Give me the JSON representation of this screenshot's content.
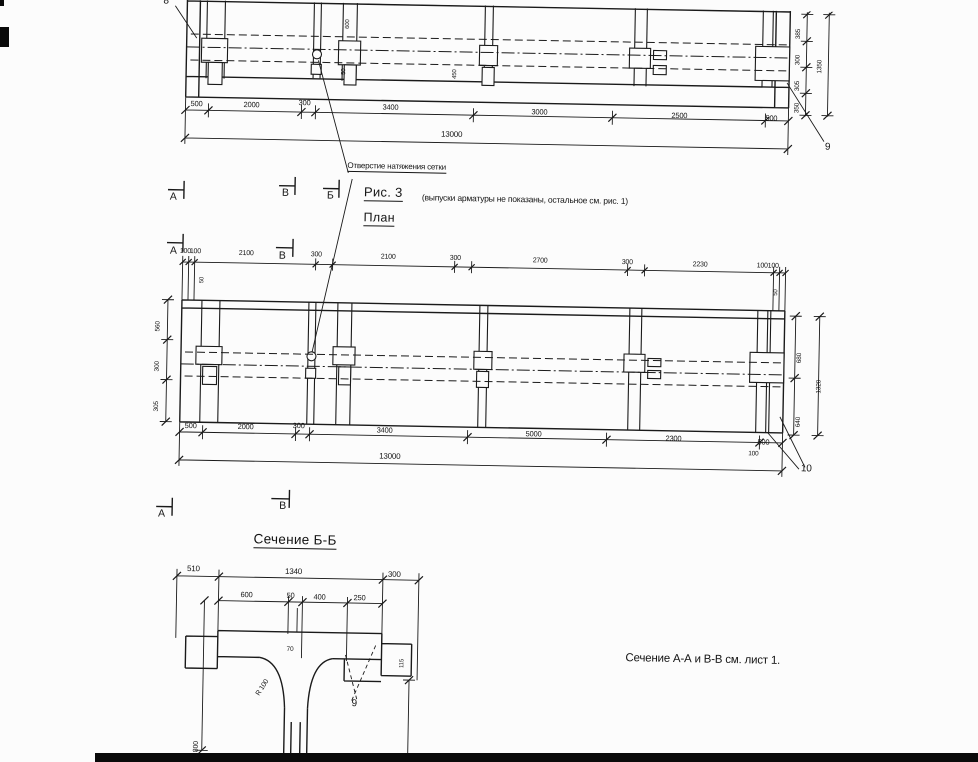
{
  "colors": {
    "ink": "#1a1a1a",
    "paper": "#fcfcfc",
    "scan_band": "#0a0a0a"
  },
  "titles": {
    "figure_caption": "Рис. 3",
    "figure_note": "(выпуски арматуры не показаны, остальное  см. рис. 1)",
    "plan_title": "План",
    "section_title": "Сечение Б-Б",
    "sheet_note": "Сечение  А-А и В-В   см. лист 1.",
    "hole_callout": "Отверстие натяжения сетки"
  },
  "labels": [
    {
      "n": "hole-callout",
      "t": "Отверстие натяжения сетки",
      "x": 349,
      "y": 159,
      "fs": 8,
      "u": 1
    },
    {
      "n": "figure-caption",
      "t": "Рис. 3",
      "x": 366,
      "y": 182,
      "fs": 13,
      "u": 1,
      "cls": "big"
    },
    {
      "n": "figure-note",
      "t": "(выпуски арматуры не показаны, остальное  см. рис. 1)",
      "x": 424,
      "y": 189,
      "fs": 8.5
    },
    {
      "n": "plan-title",
      "t": "План",
      "x": 366,
      "y": 208,
      "fs": 12.5,
      "u": 1,
      "cls": "big"
    },
    {
      "n": "section-title",
      "t": "Сечение Б-Б",
      "x": 262,
      "y": 531,
      "fs": 13.5,
      "u": 1,
      "cls": "big"
    },
    {
      "n": "sheet-note",
      "t": "Сечение  А-А и В-В   см. лист 1.",
      "x": 636,
      "y": 644,
      "fs": 11.5
    },
    {
      "n": "mark-A-elevation",
      "t": "А",
      "x": 172,
      "y": 192,
      "fs": 10.5
    },
    {
      "n": "mark-V-elevation",
      "t": "В",
      "x": 284,
      "y": 186,
      "fs": 10.5
    },
    {
      "n": "mark-B-elevation",
      "t": "Б",
      "x": 329,
      "y": 188,
      "fs": 10.5
    },
    {
      "n": "mark-A-plan-top",
      "t": "А",
      "x": 173,
      "y": 246,
      "fs": 10.5
    },
    {
      "n": "mark-V-plan-top",
      "t": "В",
      "x": 282,
      "y": 249,
      "fs": 10.5
    },
    {
      "n": "mark-A-plan-bottom",
      "t": "А",
      "x": 166,
      "y": 509,
      "fs": 10.5
    },
    {
      "n": "mark-V-plan-bottom",
      "t": "В",
      "x": 287,
      "y": 499,
      "fs": 10.5
    },
    {
      "n": "pos-8",
      "t": "8",
      "x": 162,
      "y": -3,
      "fs": 10
    },
    {
      "n": "pos-9-elevation",
      "t": "9",
      "x": 826,
      "y": 131,
      "fs": 10
    },
    {
      "n": "pos-10-plan",
      "t": "10",
      "x": 808,
      "y": 453,
      "fs": 10
    },
    {
      "n": "pos-9-section",
      "t": "9",
      "x": 363,
      "y": 696,
      "fs": 10
    },
    {
      "n": "elev-dim",
      "t": "500",
      "x": 191,
      "y": 100,
      "fs": 7.5
    },
    {
      "n": "elev-dim",
      "t": "2000",
      "x": 244,
      "y": 100,
      "fs": 7.5
    },
    {
      "n": "elev-dim",
      "t": "300",
      "x": 299,
      "y": 97,
      "fs": 7.5
    },
    {
      "n": "elev-dim",
      "t": "3400",
      "x": 383,
      "y": 100,
      "fs": 7.5
    },
    {
      "n": "elev-dim",
      "t": "3000",
      "x": 532,
      "y": 102,
      "fs": 7.5
    },
    {
      "n": "elev-dim",
      "t": "2500",
      "x": 672,
      "y": 103,
      "fs": 7.5
    },
    {
      "n": "elev-dim",
      "t": "500",
      "x": 766,
      "y": 104,
      "fs": 7.5
    },
    {
      "n": "elev-dim-total",
      "t": "13000",
      "x": 442,
      "y": 126,
      "fs": 8
    },
    {
      "n": "elev-dim-rot",
      "t": "385",
      "x": 795,
      "y": 28,
      "fs": 6.5,
      "r": -90
    },
    {
      "n": "elev-dim-rot",
      "t": "300",
      "x": 795,
      "y": 54,
      "fs": 6.5,
      "r": -90
    },
    {
      "n": "elev-dim-rot",
      "t": "305",
      "x": 795,
      "y": 80,
      "fs": 6.5,
      "r": -90
    },
    {
      "n": "elev-dim-rot",
      "t": "350",
      "x": 795,
      "y": 102,
      "fs": 6.5,
      "r": -90
    },
    {
      "n": "elev-dim-rot-total",
      "t": "1350",
      "x": 817,
      "y": 62,
      "fs": 6.5,
      "r": -90
    },
    {
      "n": "elev-dim-rot",
      "t": "600",
      "x": 344,
      "y": 26,
      "fs": 6,
      "r": -90
    },
    {
      "n": "elev-dim-rot",
      "t": "50",
      "x": 341,
      "y": 72,
      "fs": 6,
      "r": -90
    },
    {
      "n": "elev-dim-rot",
      "t": "450",
      "x": 452,
      "y": 74,
      "fs": 6,
      "r": -90
    },
    {
      "n": "plan-dim-top",
      "t": "100",
      "x": 183,
      "y": 248,
      "fs": 7
    },
    {
      "n": "plan-dim-top",
      "t": "100",
      "x": 193,
      "y": 248,
      "fs": 7
    },
    {
      "n": "plan-dim-top",
      "t": "2100",
      "x": 242,
      "y": 249,
      "fs": 7
    },
    {
      "n": "plan-dim-top",
      "t": "300",
      "x": 314,
      "y": 249,
      "fs": 7
    },
    {
      "n": "plan-dim-top",
      "t": "2100",
      "x": 384,
      "y": 250,
      "fs": 7
    },
    {
      "n": "plan-dim-top",
      "t": "300",
      "x": 453,
      "y": 250,
      "fs": 7
    },
    {
      "n": "plan-dim-top",
      "t": "2700",
      "x": 536,
      "y": 251,
      "fs": 7
    },
    {
      "n": "plan-dim-top",
      "t": "300",
      "x": 625,
      "y": 251,
      "fs": 7
    },
    {
      "n": "plan-dim-top",
      "t": "2230",
      "x": 696,
      "y": 252,
      "fs": 7
    },
    {
      "n": "plan-dim-top",
      "t": "100",
      "x": 760,
      "y": 252,
      "fs": 7
    },
    {
      "n": "plan-dim-top",
      "t": "100",
      "x": 771,
      "y": 252,
      "fs": 7
    },
    {
      "n": "plan-dim-rot",
      "t": "50",
      "x": 203,
      "y": 283,
      "fs": 6,
      "r": -90
    },
    {
      "n": "plan-dim-rot",
      "t": "50",
      "x": 777,
      "y": 285,
      "fs": 6,
      "r": -90
    },
    {
      "n": "plan-dim-left",
      "t": "560",
      "x": 160,
      "y": 332,
      "fs": 6.5,
      "r": -90
    },
    {
      "n": "plan-dim-left",
      "t": "300",
      "x": 160,
      "y": 372,
      "fs": 6.5,
      "r": -90
    },
    {
      "n": "plan-dim-left",
      "t": "305",
      "x": 160,
      "y": 412,
      "fs": 6.5,
      "r": -90
    },
    {
      "n": "plan-dim-right",
      "t": "680",
      "x": 802,
      "y": 352,
      "fs": 6.5,
      "r": -90
    },
    {
      "n": "plan-dim-right",
      "t": "640",
      "x": 802,
      "y": 416,
      "fs": 6.5,
      "r": -90
    },
    {
      "n": "plan-dim-right-total",
      "t": "1320",
      "x": 822,
      "y": 382,
      "fs": 6.5,
      "r": -90
    },
    {
      "n": "plan-dim-bottom",
      "t": "500",
      "x": 191,
      "y": 422,
      "fs": 7.5
    },
    {
      "n": "plan-dim-bottom",
      "t": "2000",
      "x": 244,
      "y": 422,
      "fs": 7.5
    },
    {
      "n": "plan-dim-bottom",
      "t": "300",
      "x": 299,
      "y": 420,
      "fs": 7.5
    },
    {
      "n": "plan-dim-bottom",
      "t": "3400",
      "x": 383,
      "y": 423,
      "fs": 7.5
    },
    {
      "n": "plan-dim-bottom",
      "t": "5000",
      "x": 532,
      "y": 424,
      "fs": 7.5
    },
    {
      "n": "plan-dim-bottom",
      "t": "2300",
      "x": 672,
      "y": 426,
      "fs": 7.5
    },
    {
      "n": "plan-dim-bottom",
      "t": "500",
      "x": 764,
      "y": 428,
      "fs": 7.5
    },
    {
      "n": "plan-dim-total",
      "t": "13000",
      "x": 386,
      "y": 449,
      "fs": 8
    },
    {
      "n": "plan-dim-small",
      "t": "100",
      "x": 755,
      "y": 441,
      "fs": 6.5
    },
    {
      "n": "sec-dim",
      "t": "510",
      "x": 196,
      "y": 565,
      "fs": 8
    },
    {
      "n": "sec-dim",
      "t": "1340",
      "x": 294,
      "y": 566,
      "fs": 8
    },
    {
      "n": "sec-dim",
      "t": "300",
      "x": 397,
      "y": 567,
      "fs": 8
    },
    {
      "n": "sec-dim",
      "t": "600",
      "x": 250,
      "y": 590,
      "fs": 7.5
    },
    {
      "n": "sec-dim",
      "t": "50",
      "x": 296,
      "y": 590,
      "fs": 7.5
    },
    {
      "n": "sec-dim",
      "t": "400",
      "x": 323,
      "y": 591,
      "fs": 7.5
    },
    {
      "n": "sec-dim",
      "t": "250",
      "x": 363,
      "y": 591,
      "fs": 7.5
    },
    {
      "n": "sec-dim",
      "t": "70",
      "x": 297,
      "y": 645,
      "fs": 6.5
    },
    {
      "n": "sec-dim-radius",
      "t": "R 100",
      "x": 266,
      "y": 692,
      "fs": 7,
      "r": -58
    },
    {
      "n": "sec-dim-rot",
      "t": "115",
      "x": 410,
      "y": 664,
      "fs": 6,
      "r": -90
    },
    {
      "n": "sec-dim-rot",
      "t": "800",
      "x": 205,
      "y": 752,
      "fs": 7,
      "r": -90
    }
  ]
}
